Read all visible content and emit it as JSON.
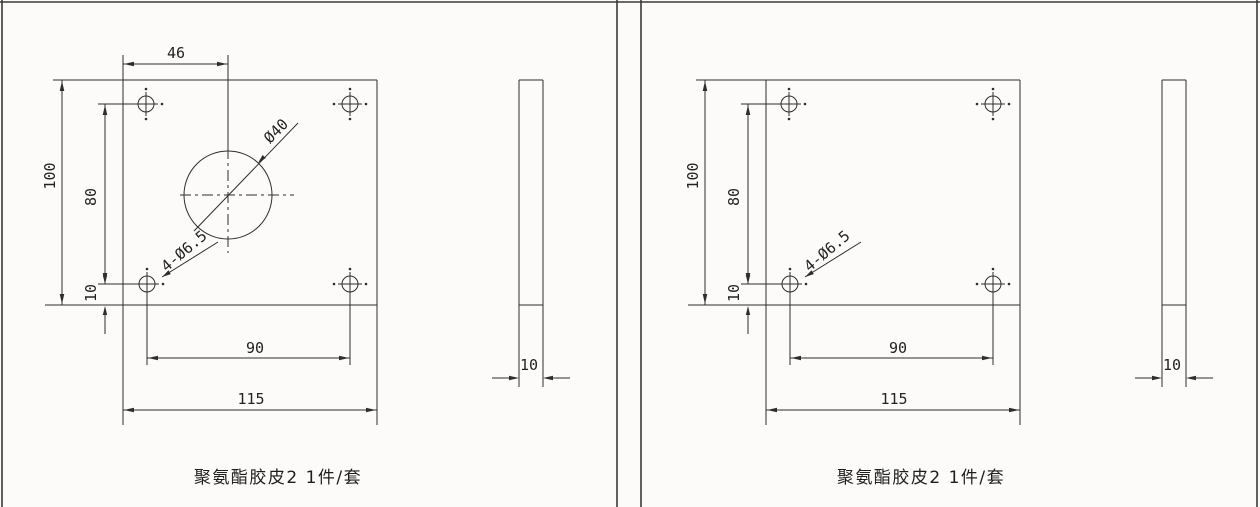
{
  "sheet": {
    "background": "#fcfbf9",
    "line_color": "#2e2e2e",
    "description": "Engineering drawing, two panels of polyurethane rubber plates"
  },
  "panels": [
    {
      "caption": "聚氨酯胶皮2 1件/套",
      "dims": {
        "top_width": "46",
        "height": "100",
        "span_v": "80",
        "offset": "10",
        "span_h": "90",
        "width": "115",
        "thickness": "10",
        "bore": "Ø40",
        "hole_note": "4-Ø6.5"
      }
    },
    {
      "caption": "聚氨酯胶皮2 1件/套",
      "dims": {
        "height": "100",
        "span_v": "80",
        "offset": "10",
        "span_h": "90",
        "width": "115",
        "thickness": "10",
        "hole_note": "4-Ø6.5"
      }
    }
  ]
}
